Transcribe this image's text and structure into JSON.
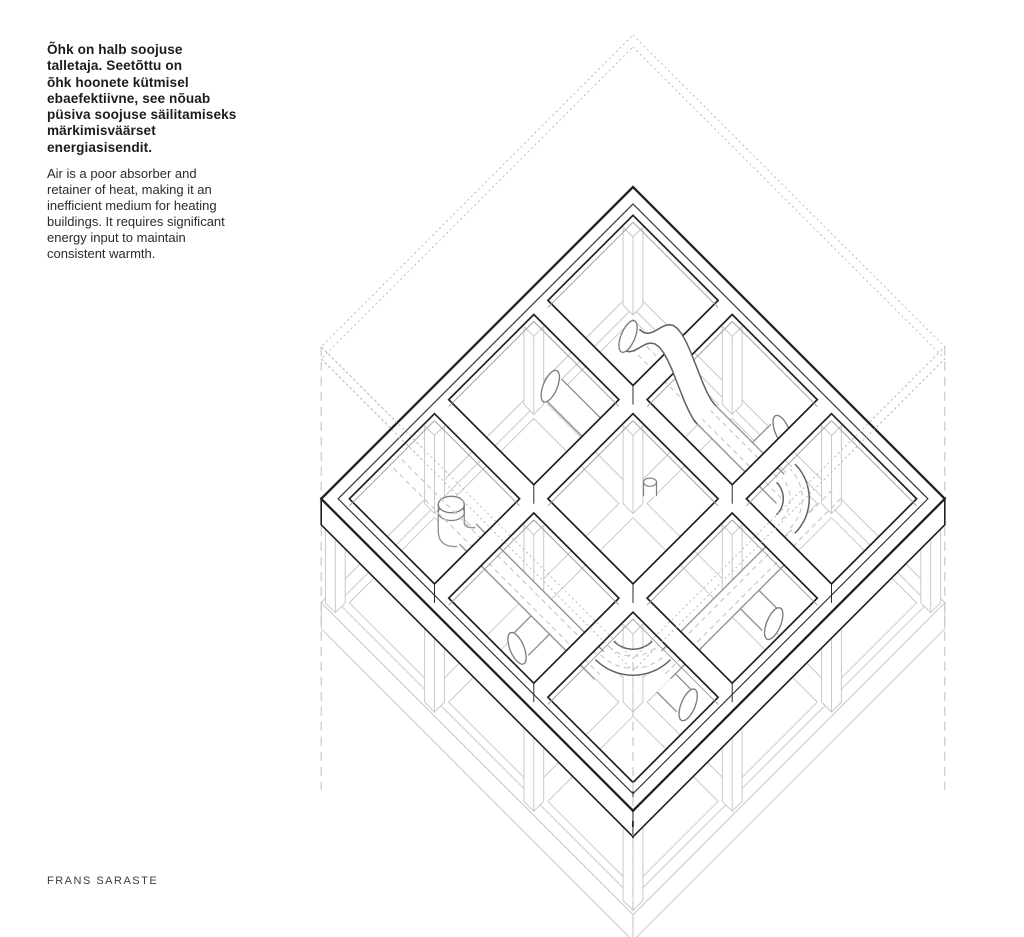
{
  "text": {
    "heading_et": "Õhk on halb soojuse\ntalletaja. Seetõttu on\nõhk hoonete kütmisel\nebaefektiivne, see nõuab\npüsiva soojuse säilitamiseks\nmärkimisväärset\nenergiasisendit.",
    "body_en": "Air is a poor absorber and\nretainer of heat, making it an\ninefficient medium for heating\nbuildings. It requires significant\nenergy input to maintain\nconsistent warmth.",
    "credit": "FRANS SARASTE"
  },
  "drawing": {
    "colors": {
      "background": "#ffffff",
      "ink": "#1f1f1f",
      "inset": "#323232",
      "ghost": "#c9c9c9",
      "envelope_dots": "#bcbcbc",
      "dashline": "#c4c4c4",
      "pipe": "#949494",
      "pipe_dark": "#616161",
      "pipe_cap": "#7d7d7d",
      "pipe_dash": "#c7c7c7",
      "wall_line": "#9a9a9a"
    }
  }
}
